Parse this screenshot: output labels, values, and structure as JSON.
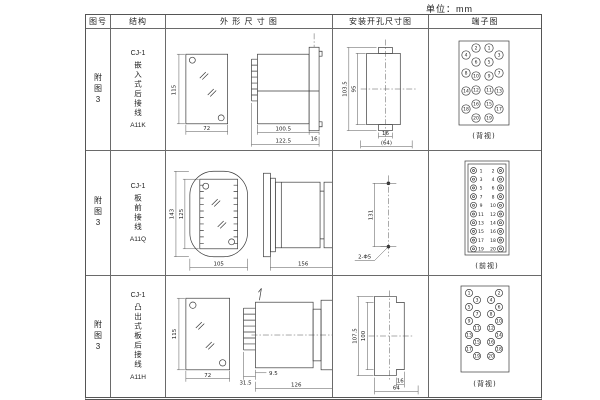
{
  "unit_label": "单位：mm",
  "header": {
    "figure_no": "图号",
    "structure": "结构",
    "outline": "外 形 尺 寸 图",
    "mounting": "安装开孔尺寸图",
    "terminal": "端子图"
  },
  "rows": [
    {
      "figure": "附图3",
      "model": "CJ-1",
      "structure": "嵌入式后接线",
      "code": "A11K",
      "outline": {
        "front_height": "115",
        "front_width": "72",
        "body_length": "100.5",
        "total_length": "122.5",
        "flange": "16"
      },
      "mounting": {
        "outer_height": "103.5",
        "inner_height": "95",
        "small_width": "16",
        "width": "(64)"
      },
      "terminal": {
        "view": "(背视)",
        "numbers": [
          "1",
          "2",
          "3",
          "4",
          "5",
          "6",
          "7",
          "8",
          "9",
          "10",
          "11",
          "12",
          "13",
          "14",
          "15",
          "16",
          "17",
          "18",
          "19",
          "20"
        ]
      }
    },
    {
      "figure": "附图3",
      "model": "CJ-1",
      "structure": "板前接线",
      "code": "A11Q",
      "outline": {
        "outer_height": "143",
        "inner_height": "125",
        "front_width": "105",
        "depth": "156",
        "body_height": "110"
      },
      "mounting": {
        "hole_spacing": "131",
        "holes": "2-Φ5"
      },
      "terminal": {
        "view": "(前视)",
        "left": [
          "1",
          "3",
          "5",
          "7",
          "9",
          "11",
          "13",
          "15",
          "17",
          "19"
        ],
        "right": [
          "2",
          "4",
          "6",
          "8",
          "10",
          "12",
          "14",
          "16",
          "18",
          "20"
        ]
      }
    },
    {
      "figure": "附图3",
      "model": "CJ-1",
      "structure": "凸出式板后接线",
      "code": "A11H",
      "outline": {
        "front_height": "115",
        "front_width": "72",
        "terminal_length": "31.5",
        "flange": "9.5",
        "body_length": "126"
      },
      "mounting": {
        "outer_height": "107.5",
        "inner_height": "100",
        "small_width": "16",
        "width": "64"
      },
      "terminal": {
        "view": "(背视)",
        "numbers": [
          "1",
          "2",
          "3",
          "4",
          "5",
          "6",
          "7",
          "8",
          "9",
          "10",
          "11",
          "12",
          "13",
          "14",
          "15",
          "16",
          "17",
          "18",
          "19",
          "20"
        ]
      }
    }
  ]
}
